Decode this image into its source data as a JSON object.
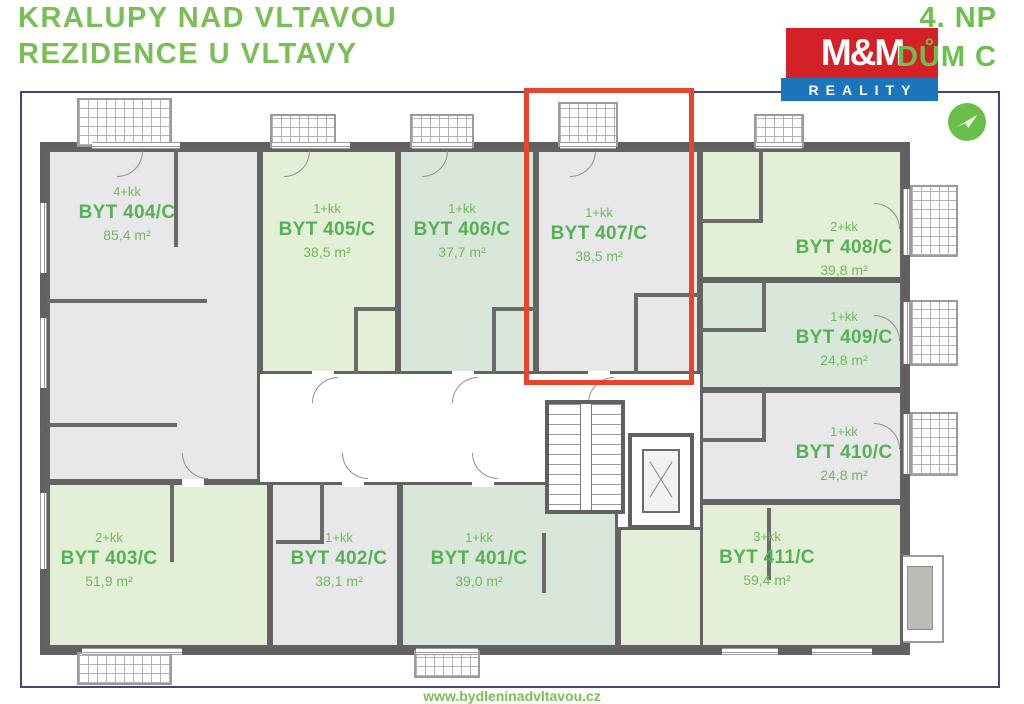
{
  "header": {
    "title_line1": "KRALUPY NAD VLTAVOU",
    "title_line2": "REZIDENCE U VLTAVY",
    "floor": "4. NP",
    "building": "DŮM C",
    "logo": {
      "top": "M&M",
      "bottom": "REALITY"
    }
  },
  "compass": {
    "icon": "paper-plane-icon"
  },
  "highlight": {
    "unit": "BYT 407/C",
    "color": "#e8432c"
  },
  "colors": {
    "title_green": "#7abf56",
    "label_green": "#54b254",
    "unit_gray": "#e8e8ea",
    "unit_green": "#e4efd7",
    "unit_mint": "#d9e7da",
    "wall": "#606060",
    "frame_navy": "#44447c",
    "logo_red": "#d42027",
    "logo_blue": "#1b75bb"
  },
  "units": [
    {
      "layout": "4+kk",
      "name": "BYT 404/C",
      "area": "85,4 m²"
    },
    {
      "layout": "1+kk",
      "name": "BYT 405/C",
      "area": "38,5 m²"
    },
    {
      "layout": "1+kk",
      "name": "BYT 406/C",
      "area": "37,7 m²"
    },
    {
      "layout": "1+kk",
      "name": "BYT 407/C",
      "area": "38,5 m²"
    },
    {
      "layout": "2+kk",
      "name": "BYT 408/C",
      "area": "39,8 m²"
    },
    {
      "layout": "1+kk",
      "name": "BYT 409/C",
      "area": "24,8 m²"
    },
    {
      "layout": "1+kk",
      "name": "BYT 410/C",
      "area": "24,8 m²"
    },
    {
      "layout": "3+kk",
      "name": "BYT 411/C",
      "area": "59,4 m²"
    },
    {
      "layout": "2+kk",
      "name": "BYT 403/C",
      "area": "51,9 m²"
    },
    {
      "layout": "1+kk",
      "name": "BYT 402/C",
      "area": "38,1 m²"
    },
    {
      "layout": "1+kk",
      "name": "BYT 401/C",
      "area": "39,0 m²"
    }
  ],
  "footer": {
    "url": "www.bydleninadvltavou.cz"
  }
}
